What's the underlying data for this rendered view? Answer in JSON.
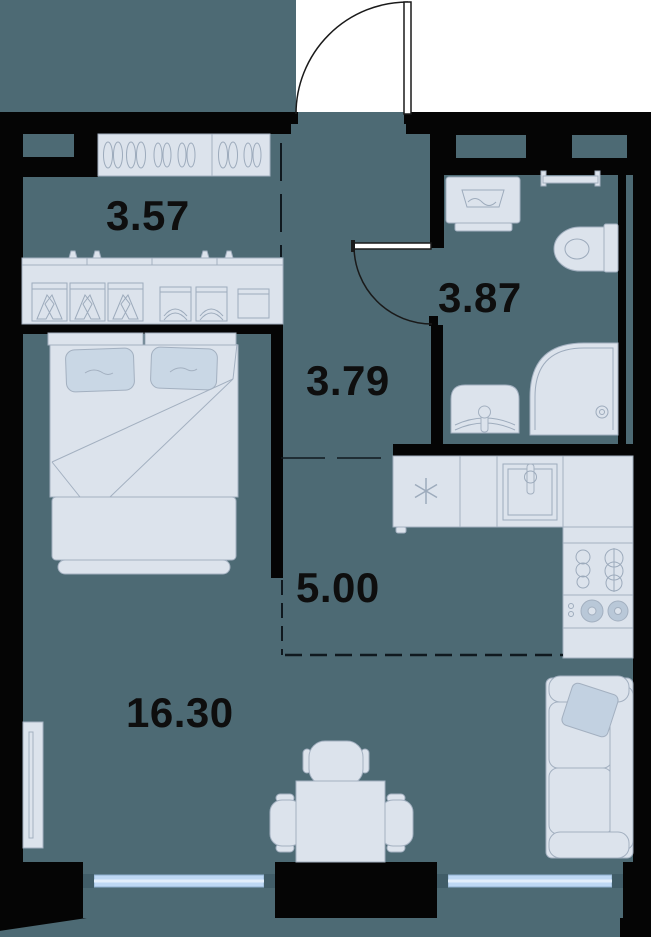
{
  "plan": {
    "title": "apartment-floor-plan",
    "rooms": {
      "wardrobe": {
        "area": "3.57"
      },
      "bathroom": {
        "area": "3.87"
      },
      "hallway": {
        "area": "3.79"
      },
      "kitchen": {
        "area": "5.00"
      },
      "living_room": {
        "area": "16.30"
      }
    },
    "colors": {
      "floor": "#4d6a74",
      "wall": "#050505",
      "furniture_fill": "#dce3ec",
      "furniture_stroke": "#a3b0c0",
      "accent_soft": "#c9d7e5",
      "window_glass": "#bed8f4",
      "window_glass_line": "#e2eefb",
      "window_frame": "#415d68",
      "door_line": "#1a1a1a",
      "label_color": "#0e0e0e"
    },
    "furniture": [
      "shoe-cabinet",
      "hanging-rail-cabinet",
      "double-bed",
      "tv-panel",
      "dining-table",
      "chair",
      "sofa",
      "fridge",
      "kitchen-sink",
      "hob",
      "tall-cabinet",
      "washing-machine",
      "towel-rail",
      "toilet",
      "bathroom-sink",
      "shower"
    ]
  }
}
